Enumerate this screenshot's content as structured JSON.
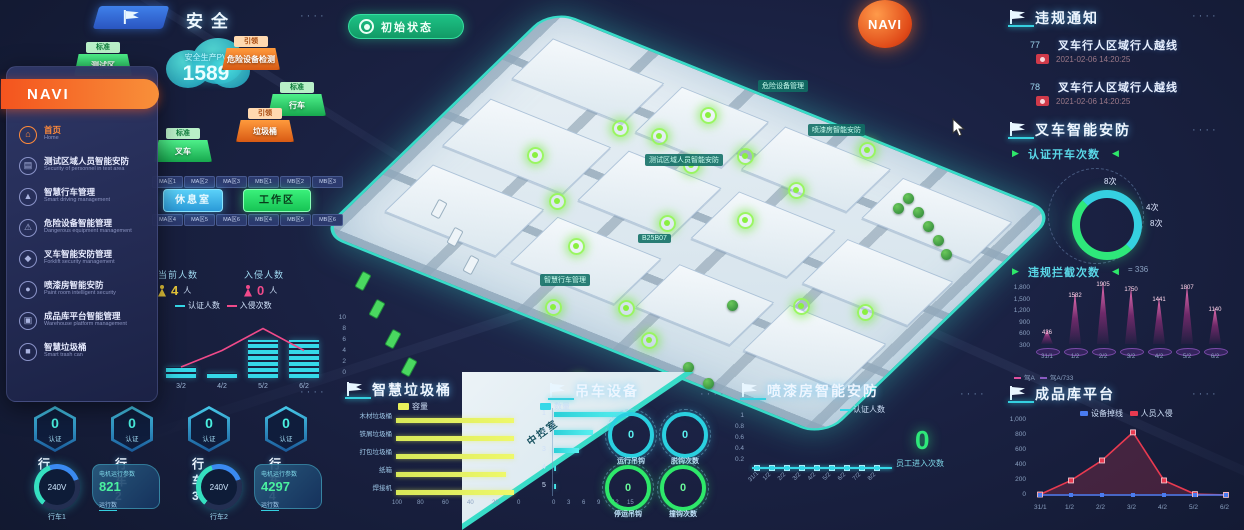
{
  "ui": {
    "dots": "····"
  },
  "colors": {
    "accent_cyan": "#35d0e0",
    "green": "#2ee87a",
    "orange": "#f4541e",
    "pink": "#ff4d94",
    "yellow": "#e8e84a",
    "blue": "#3f80ea",
    "map_teal": "#38dcc8"
  },
  "topbar": {
    "title": "安全"
  },
  "status_button": {
    "label": "初始状态"
  },
  "navi_badge": {
    "label": "NAVI"
  },
  "cloud": {
    "caption": "安全生产PV",
    "value": "1589"
  },
  "iso_buttons": [
    {
      "ribbon": "标准",
      "label": "测试区",
      "color": "green"
    },
    {
      "ribbon": "引领",
      "label": "危险设备检测",
      "color": "orange"
    },
    {
      "ribbon": "标准",
      "label": "行车",
      "color": "green"
    },
    {
      "ribbon": "引领",
      "label": "垃圾桶",
      "color": "orange"
    },
    {
      "ribbon": "标准",
      "label": "叉车",
      "color": "green"
    }
  ],
  "nav_menu": {
    "title": "NAVI",
    "items": [
      {
        "icon": "⌂",
        "label": "首页",
        "sub": "Home",
        "active": true
      },
      {
        "icon": "▤",
        "label": "测试区域人员智能安防",
        "sub": "Security of personnel in test area",
        "active": false
      },
      {
        "icon": "▲",
        "label": "智慧行车管理",
        "sub": "Smart driving management",
        "active": false
      },
      {
        "icon": "⚠",
        "label": "危险设备智能管理",
        "sub": "Dangerous equipment management",
        "active": false
      },
      {
        "icon": "◆",
        "label": "叉车智能安防管理",
        "sub": "Forklift security management",
        "active": false
      },
      {
        "icon": "●",
        "label": "喷漆房智能安防",
        "sub": "Paint room intelligent security",
        "active": false
      },
      {
        "icon": "▣",
        "label": "成品库平台智能管理",
        "sub": "Warehouse platform management",
        "active": false
      },
      {
        "icon": "■",
        "label": "智慧垃圾桶",
        "sub": "Smart trash can",
        "active": false
      }
    ]
  },
  "zones": {
    "row1": [
      "MA区1",
      "MA区2",
      "MA区3",
      "MB区1",
      "MB区2",
      "MB区3"
    ],
    "row2": [
      "MA区4",
      "MA区5",
      "MA区6",
      "MB区4",
      "MB区5",
      "MB区6"
    ],
    "btn_left": "休息室",
    "btn_right": "工作区"
  },
  "people": {
    "stats": [
      {
        "label": "当前人数",
        "value": "4",
        "unit": "人"
      },
      {
        "label": "入侵人数",
        "value": "0",
        "unit": "人"
      }
    ],
    "chart": {
      "type": "bar+line",
      "legend": [
        "认证人数",
        "入侵次数"
      ],
      "x": [
        "3/2",
        "4/2",
        "5/2",
        "6/2"
      ],
      "bars": [
        2,
        1,
        7,
        7
      ],
      "line": [
        2,
        5,
        9,
        5
      ],
      "right_axis": [
        "10",
        "8",
        "6",
        "4",
        "2",
        "0"
      ]
    }
  },
  "violations": {
    "title": "违规通知",
    "items": [
      {
        "id": "77",
        "text": "叉车行人区域行人越线",
        "time": "2021-02-06 14:20:25"
      },
      {
        "id": "78",
        "text": "叉车行人区域行人越线",
        "time": "2021-02-06 14:20:25"
      }
    ]
  },
  "forklift": {
    "title": "叉车智能安防",
    "stat_label": "认证开车次数",
    "donut_labels": [
      "8次",
      "4次",
      "8次"
    ],
    "intercept": {
      "type": "spike-bar",
      "label": "违规拦截次数",
      "badge": "336",
      "y_ticks": [
        "1,800",
        "1,500",
        "1,200",
        "900",
        "600",
        "300"
      ],
      "values": [
        436,
        1582,
        1905,
        1750,
        1441,
        1807,
        1140
      ],
      "x": [
        "31/1",
        "1/2",
        "2/2",
        "3/2",
        "4/2",
        "5/2",
        "6/2"
      ],
      "legend": [
        "驾A",
        "驾A/733"
      ]
    }
  },
  "warehouse": {
    "title": "成品库平台",
    "chart": {
      "type": "line",
      "legend": [
        {
          "label": "设备掉线",
          "color": "#4a7cf0"
        },
        {
          "label": "人员入侵",
          "color": "#e83a50"
        }
      ],
      "y_ticks": [
        "1,000",
        "800",
        "600",
        "400",
        "200",
        "0"
      ],
      "x": [
        "31/1",
        "1/2",
        "2/2",
        "3/2",
        "4/2",
        "5/2",
        "6/2"
      ],
      "red": [
        20,
        210,
        480,
        860,
        210,
        25,
        15
      ],
      "blue": [
        0,
        0,
        0,
        0,
        0,
        0,
        0
      ]
    }
  },
  "vehicles": {
    "hexes": [
      {
        "name": "行车1",
        "value": "0",
        "tag": "认证"
      },
      {
        "name": "行车2",
        "value": "0",
        "tag": "认证"
      },
      {
        "name": "行车3",
        "value": "0",
        "tag": "认证"
      },
      {
        "name": "行车4",
        "value": "0",
        "tag": "认证"
      }
    ],
    "gauges": [
      {
        "value": "240V",
        "name": "行车1"
      },
      {
        "value": "240V",
        "name": "行车2"
      }
    ],
    "cards": [
      {
        "title": "电机运行参数",
        "value": "821",
        "label": "运行数"
      },
      {
        "title": "电机运行参数",
        "value": "4297",
        "label": "运行数"
      }
    ]
  },
  "trash": {
    "title": "智慧垃圾桶",
    "legend_left": "容量",
    "legend_right": "数量",
    "left_chart": {
      "type": "bar",
      "categories": [
        "木材垃圾桶",
        "铁屑垃圾桶",
        "打包垃圾桶",
        "纸箱",
        "焊接机"
      ],
      "values": [
        97,
        97,
        97,
        90,
        97
      ],
      "axis": [
        "100",
        "80",
        "60",
        "40",
        "20",
        "0"
      ]
    },
    "right_chart": {
      "type": "bar",
      "rows": [
        "1",
        "2",
        "3",
        "4",
        "5"
      ],
      "values": [
        15,
        8,
        5,
        0.4,
        0.4
      ],
      "axis": [
        "0",
        "3",
        "6",
        "9",
        "12",
        "15"
      ]
    }
  },
  "crane": {
    "title": "吊车设备",
    "ribbon_text": "中控室",
    "rings": [
      {
        "value": "0",
        "label": "运行吊钩",
        "color": "cy"
      },
      {
        "value": "0",
        "label": "脱钩次数",
        "color": "cy"
      },
      {
        "value": "0",
        "label": "停运吊钩",
        "color": "gr"
      },
      {
        "value": "0",
        "label": "撞钩次数",
        "color": "gr"
      }
    ]
  },
  "paint": {
    "title": "喷漆房智能安防",
    "chart": {
      "type": "line",
      "legend": "认证人数",
      "y_ticks": [
        "1",
        "0.8",
        "0.6",
        "0.4",
        "0.2"
      ],
      "x": [
        "31/1",
        "1/2",
        "2/2",
        "3/2",
        "4/2",
        "5/2",
        "6/2",
        "7/2",
        "8/2"
      ],
      "values": [
        0,
        0,
        0,
        0,
        0,
        0,
        0,
        0,
        0
      ]
    },
    "big_value": "0",
    "big_label": "员工进入次数"
  },
  "map": {
    "labels": [
      "危险设备管理",
      "喷漆房智能安防",
      "测试区域人员智能安防",
      "B25B07",
      "智慧行车管理",
      "智慧垃圾桶"
    ]
  }
}
